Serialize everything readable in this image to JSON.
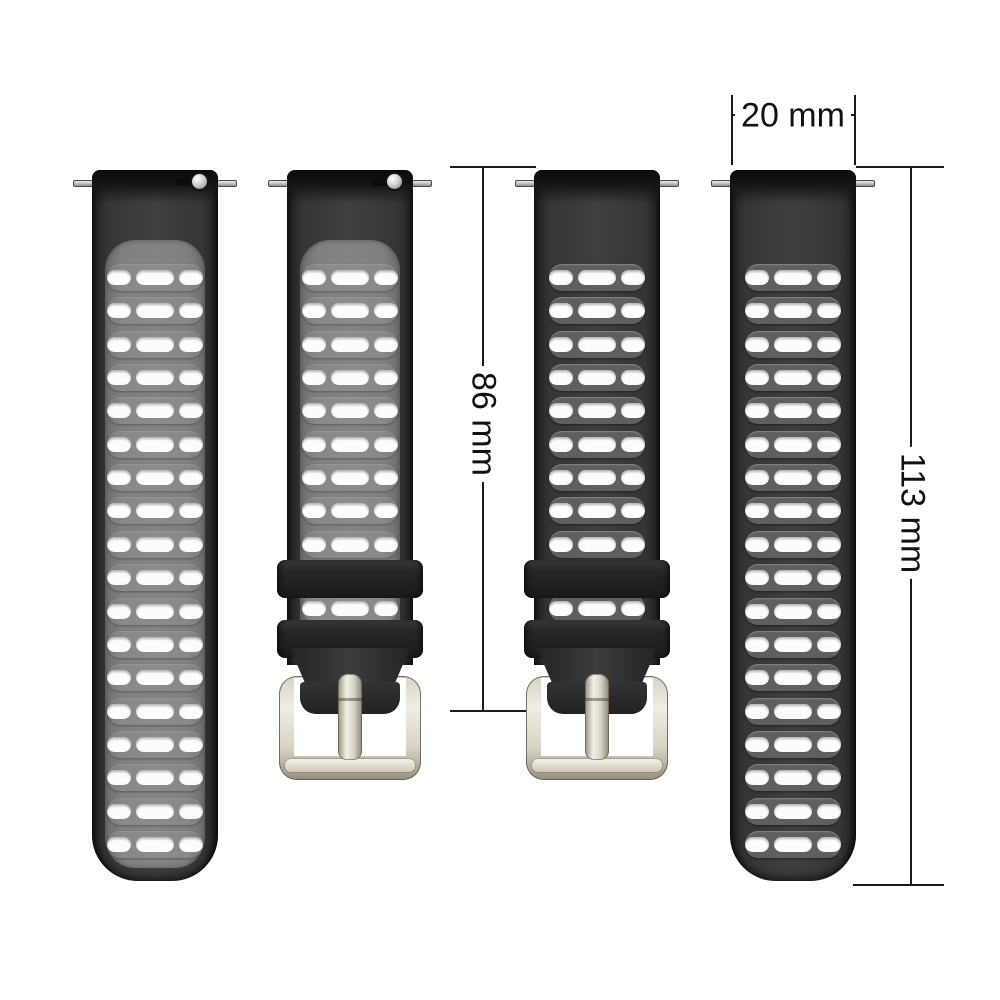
{
  "scene": {
    "description": "watch strap size diagram with four silicone straps and dimension lines",
    "background": "#ffffff"
  },
  "annotations": {
    "width": {
      "label": "20 mm"
    },
    "strap_length": {
      "label": "86 mm"
    },
    "total_length": {
      "label": "113 mm"
    }
  },
  "colors": {
    "dimension_line": "#1a1a1a",
    "strap_edge": "#1e1e1e",
    "strap_mid": "#404040",
    "top_cap": "#0a0a0a",
    "inset_gray": "#808080",
    "row_band_gray": "#5f5f5f",
    "hole_white": "#fcfcfc",
    "keeper_black": "#262626",
    "buckle_light": "#f0eee5",
    "buckle_mid": "#d6d2c3",
    "buckle_dark": "#968f7f",
    "pin_light": "#ececec",
    "pin_dark": "#909090"
  },
  "straps": [
    {
      "name": "two-tone-strap-plain-end",
      "variant": "two-tone",
      "end": "plain",
      "x": 92,
      "rows": 18,
      "quick_release_knob": true
    },
    {
      "name": "two-tone-strap-buckle-end",
      "variant": "two-tone",
      "end": "buckle",
      "x": 287,
      "rows": 9,
      "quick_release_knob": true
    },
    {
      "name": "black-strap-buckle-end",
      "variant": "black",
      "end": "buckle",
      "x": 534,
      "rows": 9,
      "quick_release_knob": false
    },
    {
      "name": "black-strap-plain-end",
      "variant": "black",
      "end": "plain",
      "x": 730,
      "rows": 18,
      "quick_release_knob": false
    }
  ]
}
